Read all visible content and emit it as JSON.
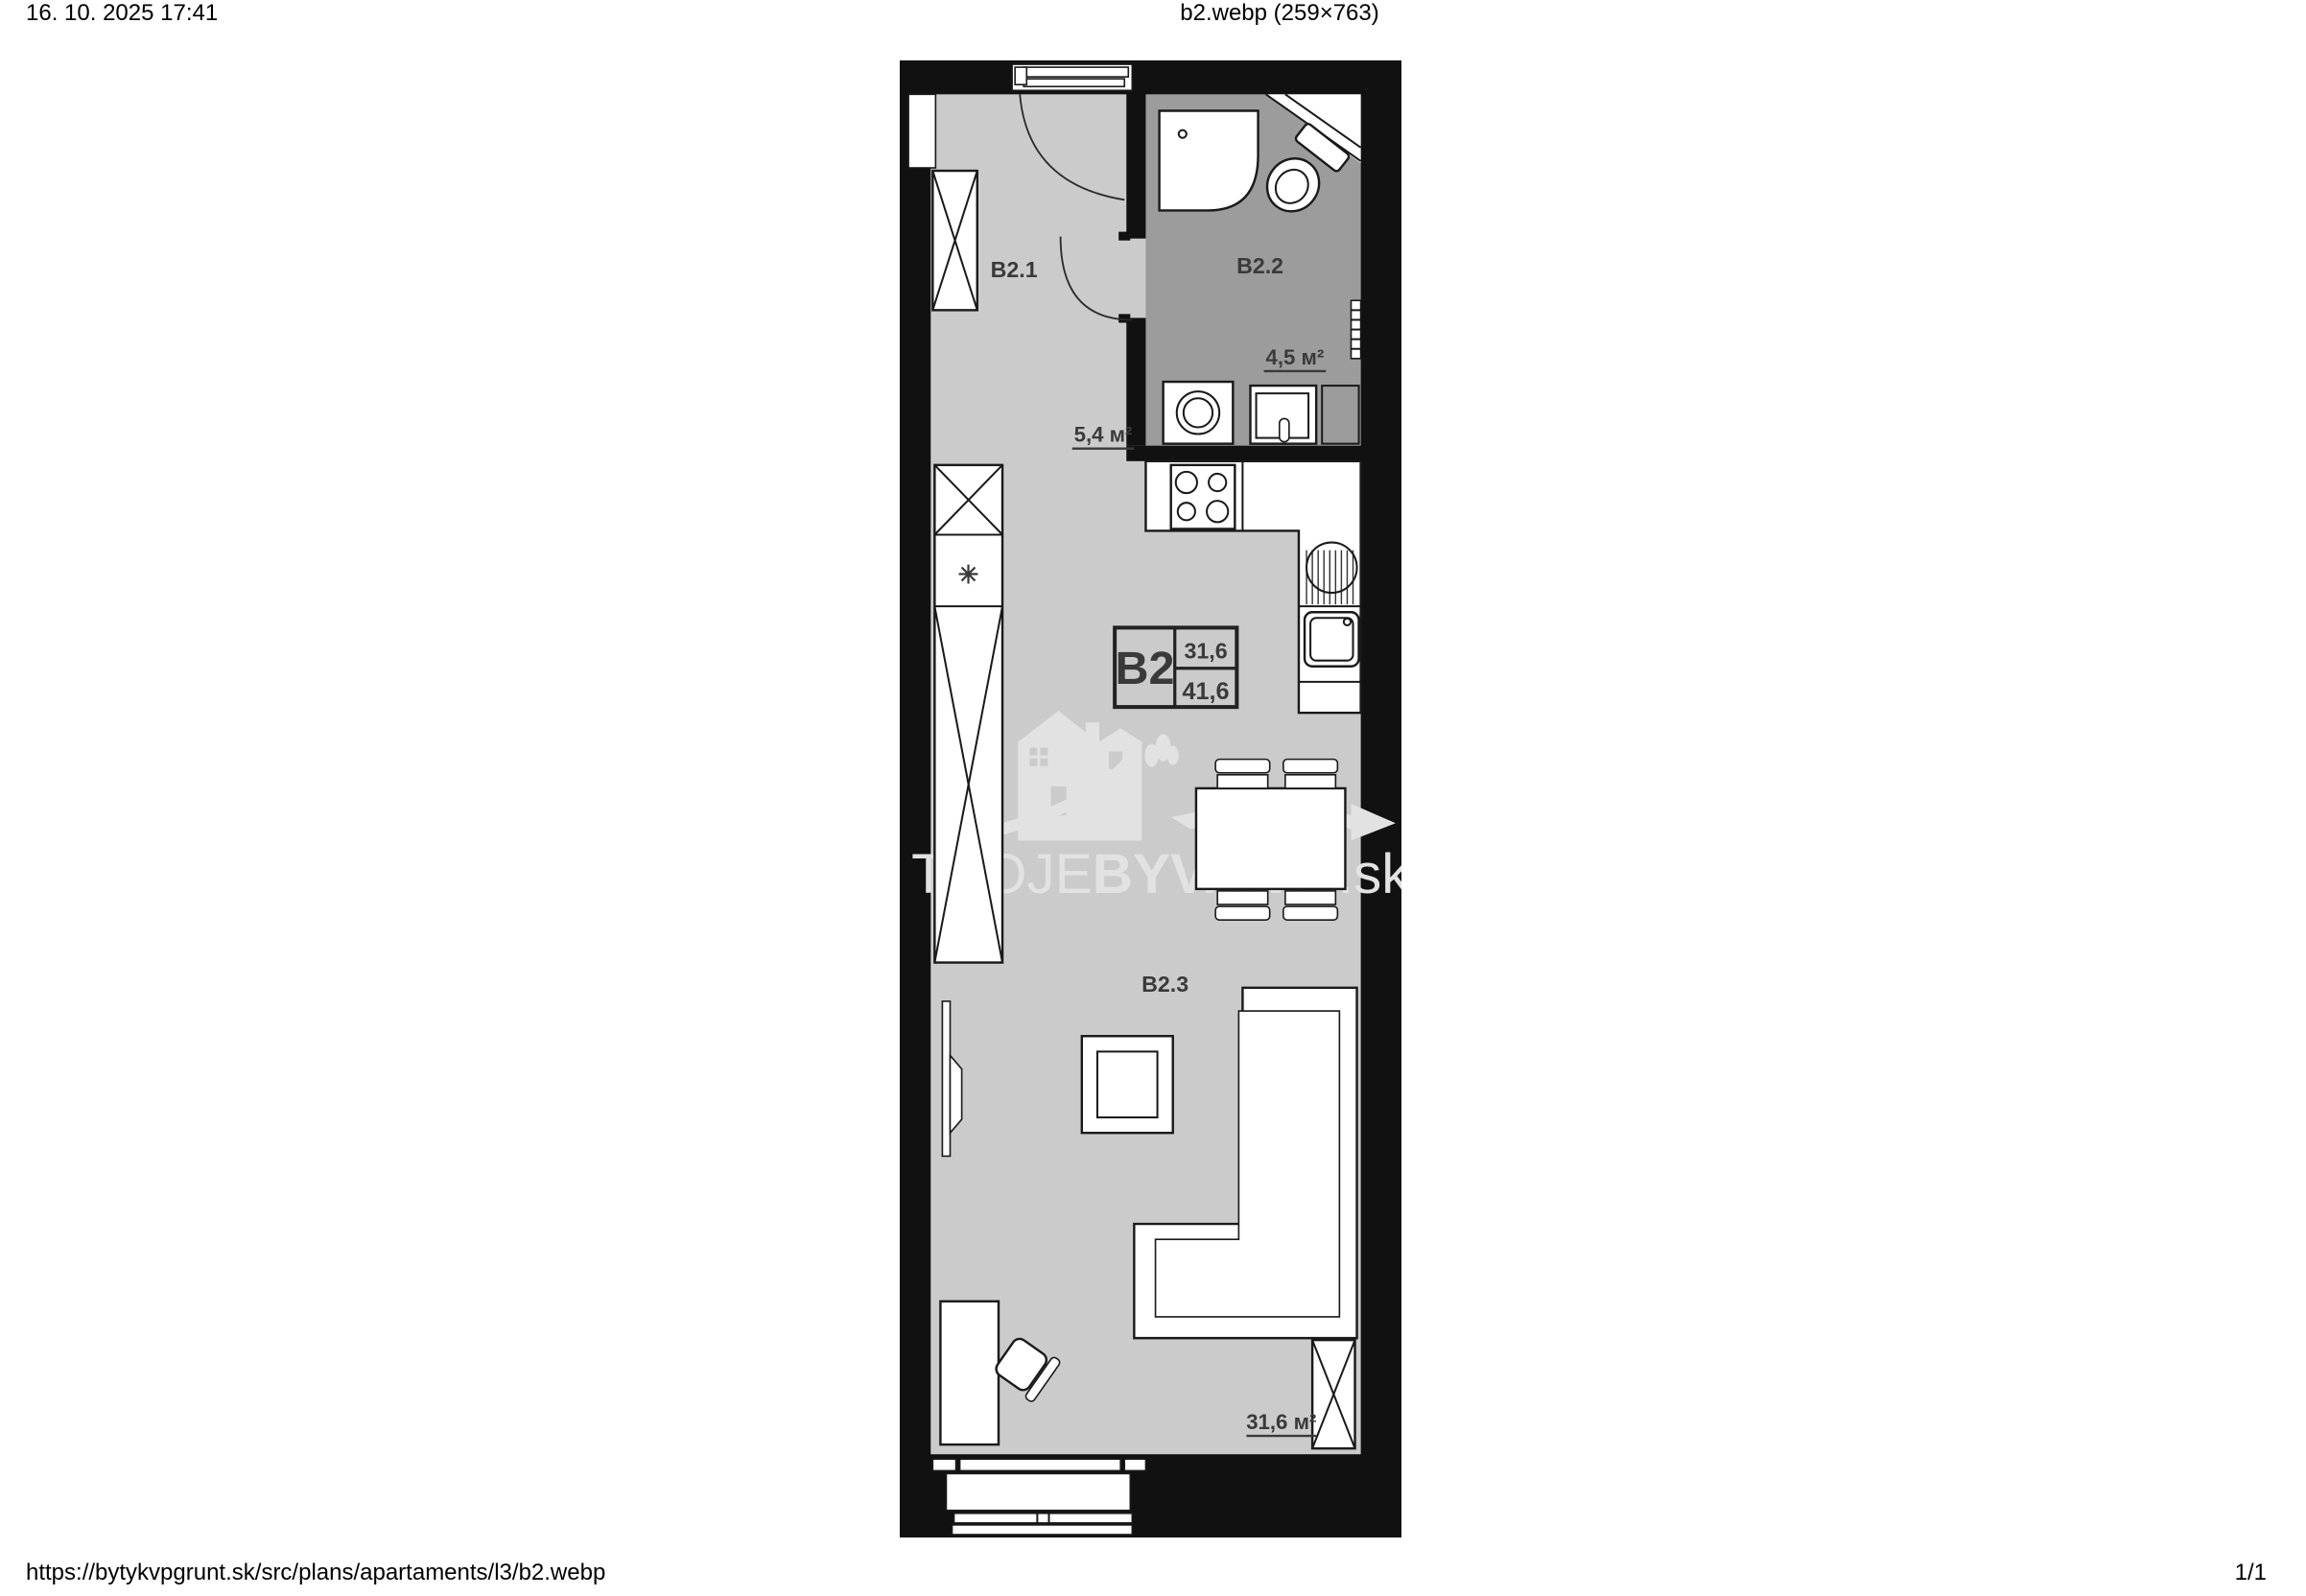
{
  "page": {
    "background": "#ffffff",
    "header": {
      "datetime": "16. 10. 2025 17:41",
      "title": "b2.webp (259×763)"
    },
    "footer": {
      "url": "https://bytykvpgrunt.sk/src/plans/apartaments/l3/b2.webp",
      "page_number": "1/1"
    }
  },
  "plan": {
    "unit_box": {
      "code": "B2",
      "living_area": "31,6",
      "total_area": "41,6"
    },
    "rooms": [
      {
        "label": "B2.1",
        "area": "5,4 м²"
      },
      {
        "label": "B2.2",
        "area": "4,5 м²"
      },
      {
        "label": "B2.3",
        "area": "31,6 м²"
      }
    ],
    "symbols": {
      "fridge": "✳"
    },
    "watermark": {
      "prefix": "TVOJE",
      "emphasis": "BYVANIE",
      "suffix": ".sk"
    },
    "colors": {
      "wall": "#111111",
      "floor": "#cbcbcb",
      "bathroom_floor": "#9c9c9c",
      "furniture": "#ffffff",
      "label": "#3a3a3a",
      "watermark": "#e2e2e2"
    }
  }
}
